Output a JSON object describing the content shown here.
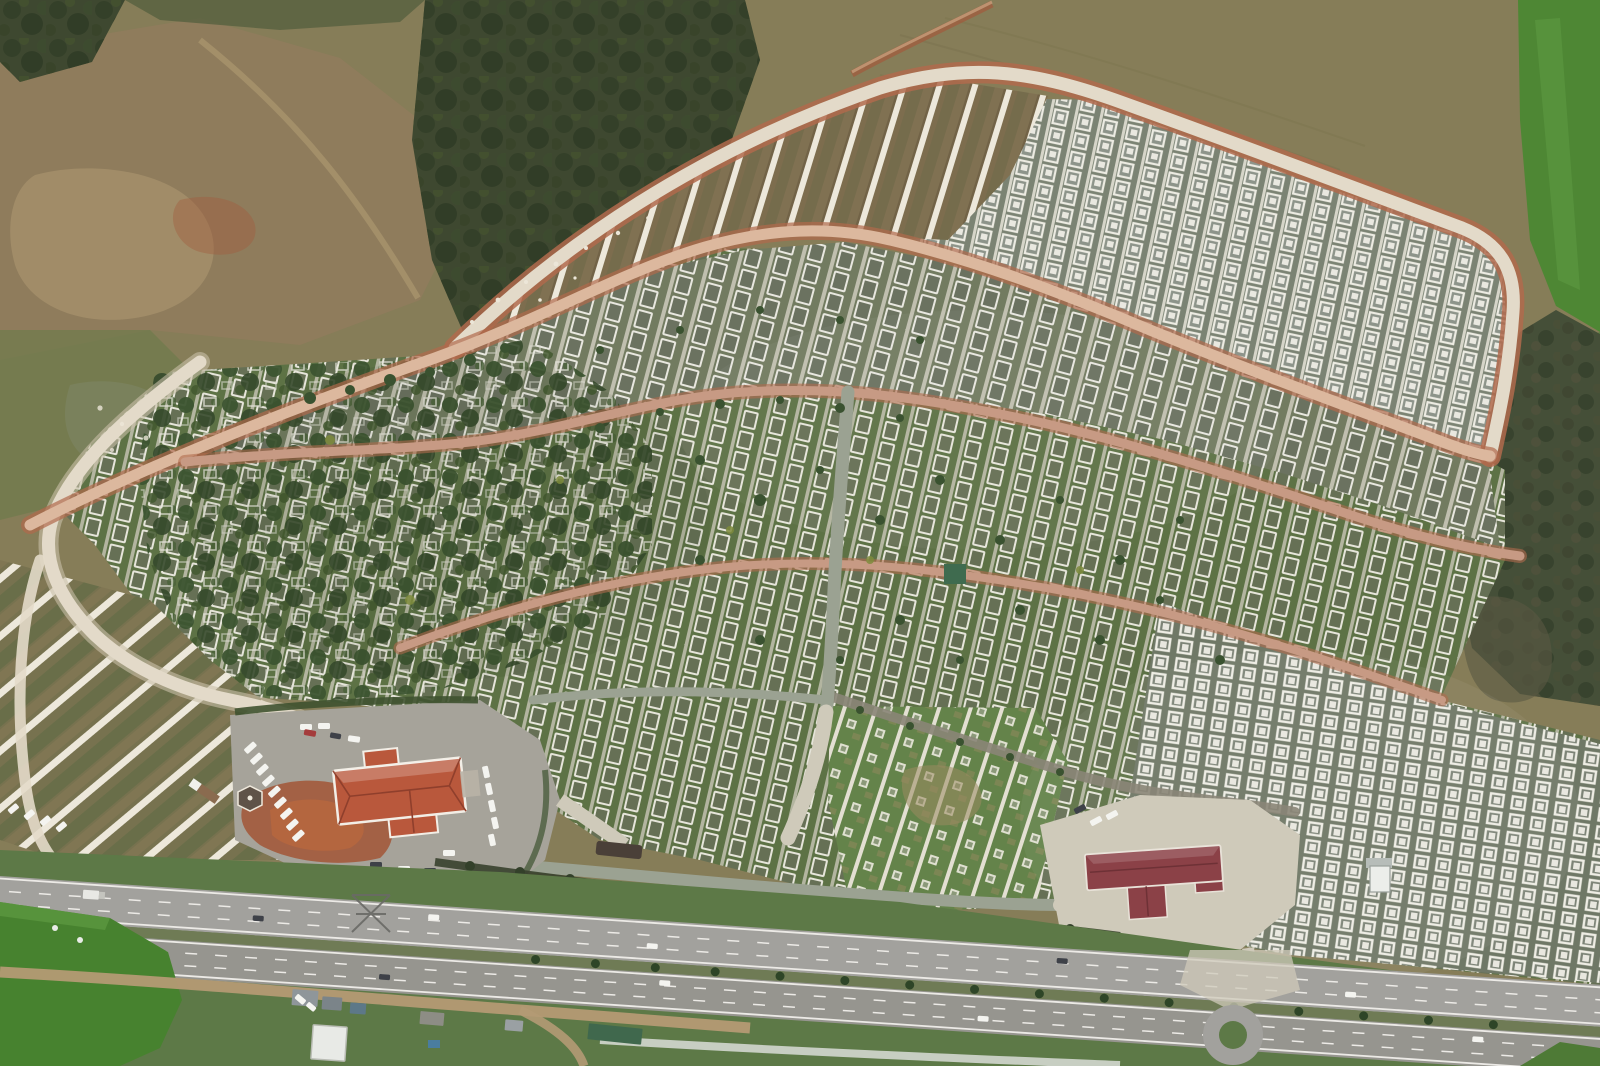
{
  "scene": {
    "title": "Aerial drone photograph — hillside cemetery complex",
    "subject": "Top-down aerial photo of a vast terraced cemetery: thousands of white-framed graves in diagonal rows, curving gravel roads, empty white grave terraces, an older tree-filled section, two red-roofed service buildings with car parks, and a dual-carriageway highway running along the bottom",
    "regions": [
      {
        "name": "rough-hillside",
        "position": "top-left",
        "desc": "bare brown earth, scrub and dark forest patches"
      },
      {
        "name": "open-field",
        "position": "top-right",
        "desc": "olive-brown plowed field"
      },
      {
        "name": "green-crop-field",
        "position": "right-edge",
        "desc": "bright green crop field"
      },
      {
        "name": "empty-terraces",
        "position": "upper-center",
        "desc": "curved band of new white concrete grave terraces between two gravel roads"
      },
      {
        "name": "grave-blocks",
        "position": "center",
        "desc": "dense diagonal rows of white-bordered graves cut by pink gravel roads"
      },
      {
        "name": "old-tree-section",
        "position": "center-left",
        "desc": "older section overgrown with dark evergreen trees"
      },
      {
        "name": "striped-terraces",
        "position": "lower-left",
        "desc": "empty white-striped terraces on brown soil"
      },
      {
        "name": "admin-building",
        "position": "bottom-center-left",
        "desc": "building with terracotta hip roof, gazebo and car park full of white cars"
      },
      {
        "name": "east-building",
        "position": "bottom-right",
        "desc": "long dark-red-roofed building with concrete forecourt"
      },
      {
        "name": "highway",
        "position": "bottom",
        "desc": "dual carriageway with tree-planted median, sparse traffic"
      },
      {
        "name": "roundabout",
        "position": "bottom-right",
        "desc": "small roundabout with green center island"
      },
      {
        "name": "service-strip",
        "position": "bottom-left",
        "desc": "dirt service road, sheds, containers and green fields"
      }
    ],
    "objects": {
      "vehicles_on_highway": 11,
      "parked_cars": "rows of mostly white cars in the west car park",
      "gazebo": "hexagonal kiosk at car-park edge",
      "power_pylon": "lattice pylon on the south verge",
      "burial_tent": "small green canopy tent among central graves"
    }
  },
  "palette": {
    "field-olive": "#867d58",
    "field-brown": "#8f7c5c",
    "dirt-light": "#a8936d",
    "dirt-red": "#a35a3c",
    "rubble-gray": "#9b958b",
    "forest-dark": "#3e4830",
    "forest-mid": "#566040",
    "meadow-green": "#6e7a4c",
    "bright-green": "#4e8734",
    "scrub-dark": "#454f38",
    "terrace-soil": "#7d6d4e",
    "stripe-white": "#ede8db",
    "road-white": "#e3dac9",
    "road-edge-red": "#b06a4c",
    "road-pink": "#c79a84",
    "road-pink-core": "#dcb89e",
    "path-gray": "#9ba292",
    "concrete": "#cfcaba",
    "cem-green": "#5d7245",
    "cem-gray": "#737c62",
    "cem-right": "#7b8373",
    "grave-white": "#e7e6de",
    "grave-dark": "#6a7160",
    "tree-dark": "#3a5230",
    "tree-yellow": "#7e8b3c",
    "asphalt": "#a2a19d",
    "asphalt-dark": "#96958f",
    "lane-white": "#eceae6",
    "verge-green": "#5d7947",
    "hedge-dark": "#39412e",
    "wall-red": "#91503c",
    "roof-orange": "#b9583c",
    "roof-dark-red": "#8b4147",
    "trim-white": "#f2eee6",
    "car-white": "#f4f4f0",
    "car-dark": "#3e4148",
    "car-red": "#a43c3c",
    "shed-gray": "#8f969a",
    "shed-blue": "#5d7888",
    "shed-green": "#40684d",
    "dirt-service": "#b49a74"
  }
}
